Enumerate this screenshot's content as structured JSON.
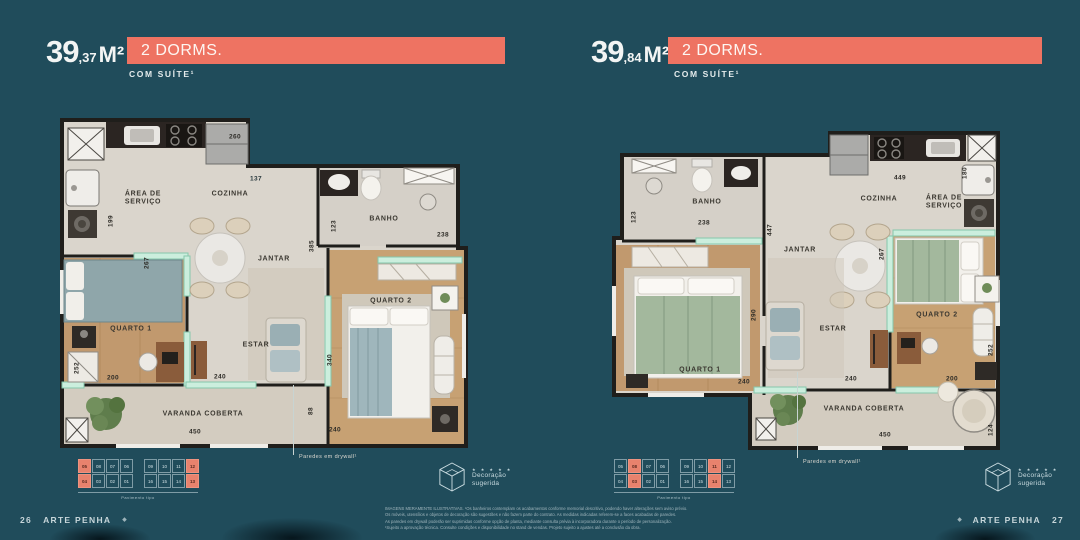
{
  "page": {
    "bg": "#204C5B",
    "accent": "#EE7362",
    "brand": "ARTE PENHA",
    "left_page_number": "26",
    "right_page_number": "27"
  },
  "plans": [
    {
      "area_int": "39",
      "area_dec": ",37",
      "area_unit": "M²",
      "dorms_label": "2 DORMS.",
      "suite_label": "COM SUÍTE¹",
      "rooms": {
        "area_servico": "ÁREA DE SERVIÇO",
        "cozinha": "COZINHA",
        "banho": "BANHO",
        "jantar": "JANTAR",
        "quarto1": "QUARTO 1",
        "estar": "ESTAR",
        "quarto2": "QUARTO 2",
        "varanda": "VARANDA COBERTA"
      },
      "dims": {
        "w260": "260",
        "w137": "137",
        "w199": "199",
        "w267": "267",
        "w123": "123",
        "w238": "238",
        "w385": "385",
        "w252": "252",
        "w200": "200",
        "w240a": "240",
        "w340": "340",
        "w88": "88",
        "w240b": "240",
        "w450": "450"
      },
      "drywall_note": "Paredes em drywall¹",
      "keyplan": {
        "rows": [
          [
            "05",
            "08",
            "07",
            "06",
            "09",
            "10",
            "11",
            "12"
          ],
          [
            "04",
            "03",
            "02",
            "01",
            "16",
            "15",
            "14",
            "13"
          ]
        ],
        "highlights": [
          "05",
          "04",
          "12",
          "13"
        ],
        "caption": "Pavimento tipo"
      },
      "logo": {
        "stars": "★ ★ ★ ★ ★",
        "line1": "Decoração",
        "line2": "sugerida"
      }
    },
    {
      "area_int": "39",
      "area_dec": ",84",
      "area_unit": "M²",
      "dorms_label": "2 DORMS.",
      "suite_label": "COM SUÍTE¹",
      "rooms": {
        "area_servico": "ÁREA DE SERVIÇO",
        "cozinha": "COZINHA",
        "banho": "BANHO",
        "jantar": "JANTAR",
        "quarto1": "QUARTO 1",
        "estar": "ESTAR",
        "quarto2": "QUARTO 2",
        "varanda": "VARANDA COBERTA"
      },
      "dims": {
        "w449": "449",
        "w180": "180",
        "w123": "123",
        "w238": "238",
        "w447": "447",
        "w267": "267",
        "w290": "290",
        "w240a": "240",
        "w240b": "240",
        "w200": "200",
        "w252": "252",
        "w450": "450",
        "w124": "124"
      },
      "drywall_note": "Paredes em drywall¹",
      "keyplan": {
        "rows": [
          [
            "05",
            "08",
            "07",
            "06",
            "09",
            "10",
            "11",
            "12"
          ],
          [
            "04",
            "03",
            "02",
            "01",
            "16",
            "15",
            "14",
            "13"
          ]
        ],
        "highlights": [
          "08",
          "03",
          "11",
          "14"
        ],
        "caption": "Pavimento tipo"
      },
      "logo": {
        "stars": "★ ★ ★ ★ ★",
        "line1": "Decoração",
        "line2": "sugerida"
      }
    }
  ],
  "disclaimer": [
    "IMAGENS MERAMENTE ILUSTRATIVAS. ¹Os banheiros contemplam os acabamentos conforme memorial descritivo, podendo haver alterações sem aviso prévio.",
    "Os móveis, utensílios e objetos de decoração são sugestões e não fazem parte do contrato. As medidas indicadas referem-se a faces acabadas de paredes.",
    "As paredes em drywall poderão ser suprimidas conforme opção de planta, mediante consulta prévia à incorporadora durante o período de personalização.",
    "¹Sujeito a aprovação técnica. Consulte condições e disponibilidade no stand de vendas. Projeto sujeito a ajustes até a conclusão da obra."
  ]
}
